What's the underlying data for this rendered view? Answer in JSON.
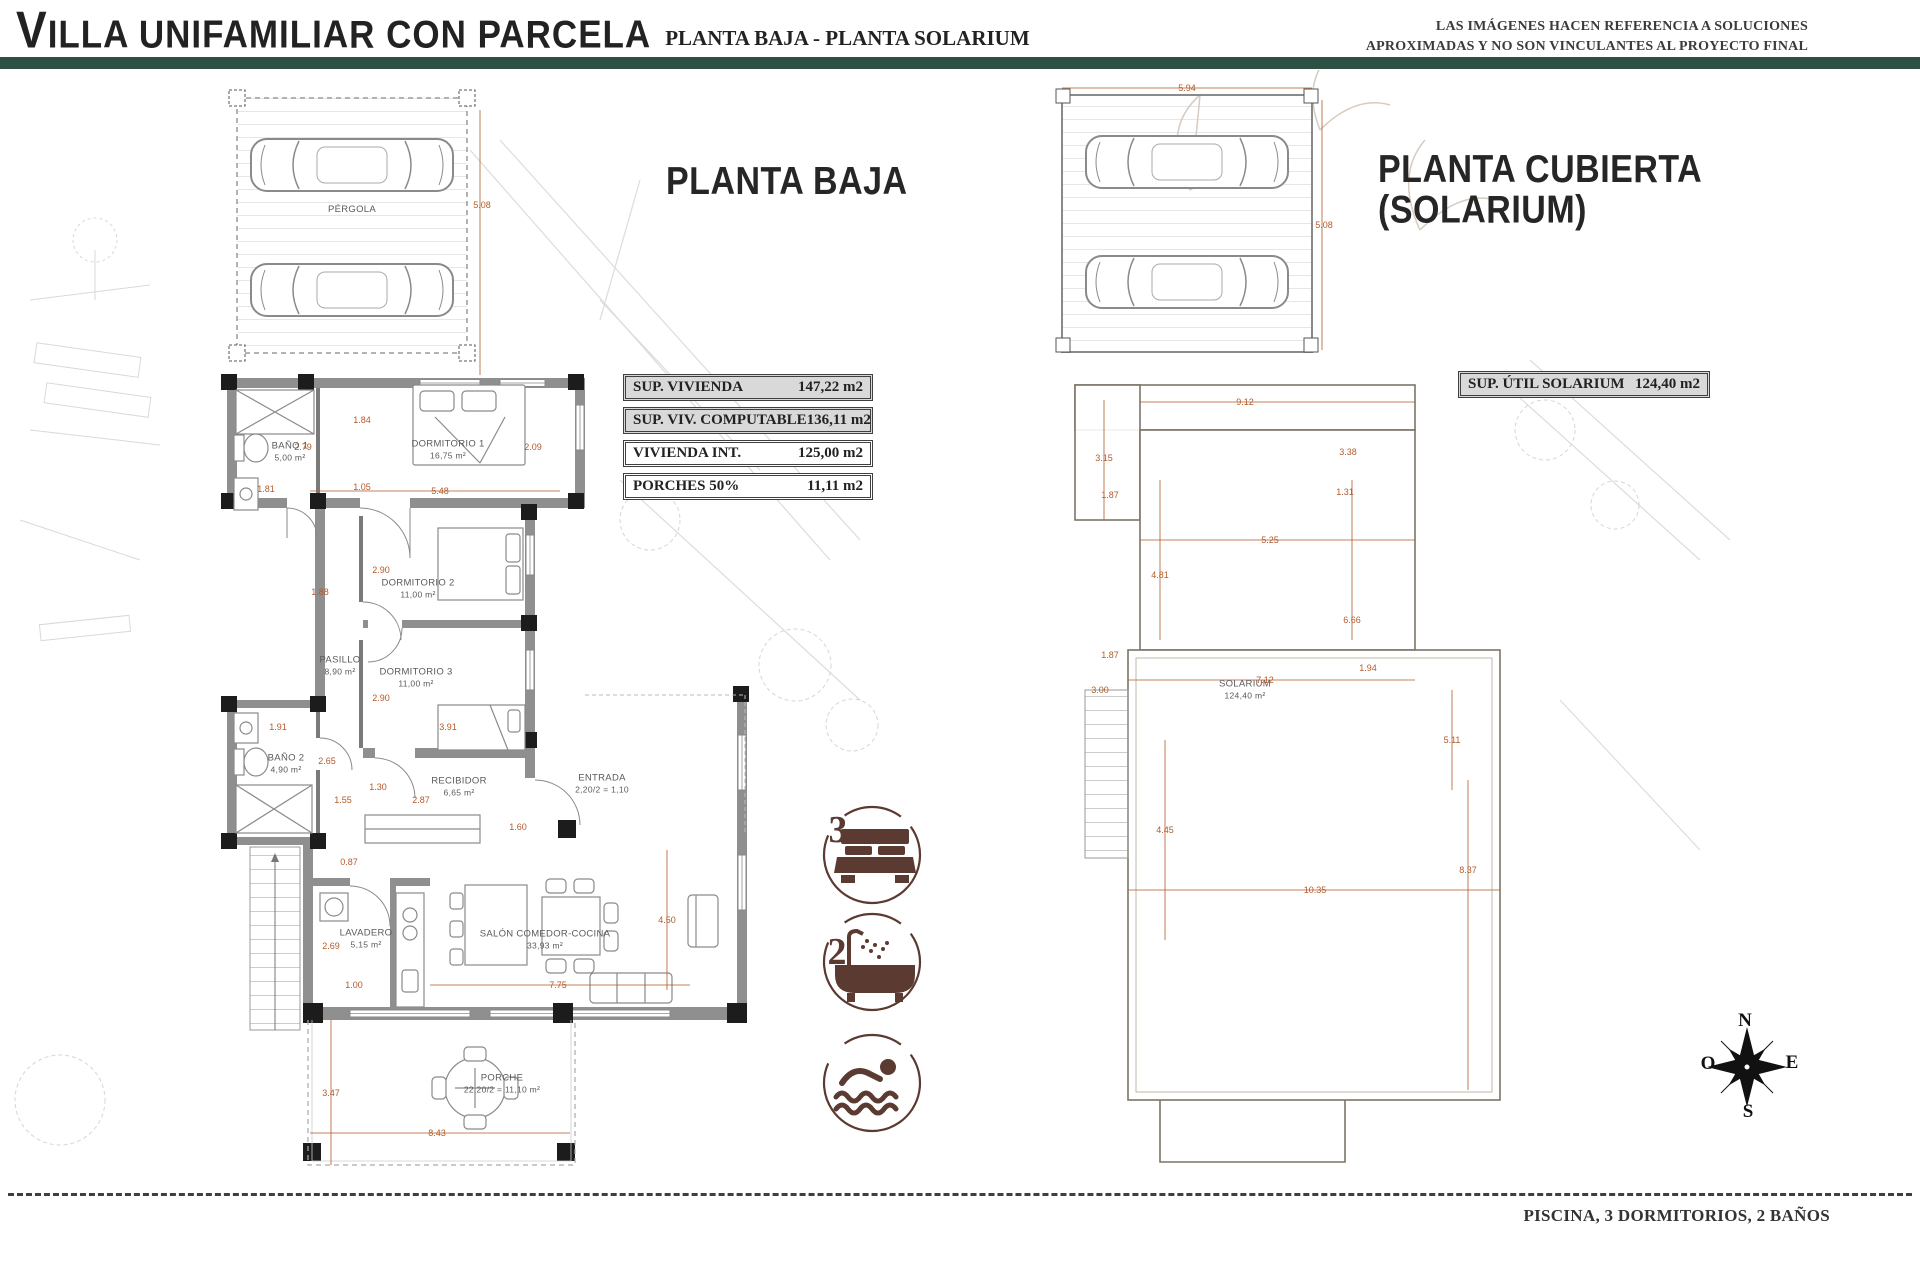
{
  "header": {
    "title_initial": "V",
    "title_rest": "ILLA UNIFAMILIAR CON PARCELA",
    "subtitle": "PLANTA BAJA - PLANTA SOLARIUM",
    "disclaimer_line1": "LAS IMÁGENES HACEN REFERENCIA A SOLUCIONES",
    "disclaimer_line2": "APROXIMADAS Y NO SON VINCULANTES AL PROYECTO FINAL",
    "accent_color": "#2c5044"
  },
  "planta_baja": {
    "title": "PLANTA BAJA",
    "areas_table": [
      {
        "label": "SUP. VIVIENDA",
        "value": "147,22 m2",
        "shaded": true
      },
      {
        "label": "SUP. VIV. COMPUTABLE",
        "value": "136,11 m2",
        "shaded": true
      },
      {
        "label": "VIVIENDA INT.",
        "value": "125,00 m2",
        "shaded": false
      },
      {
        "label": "PORCHES 50%",
        "value": "11,11 m2",
        "shaded": false
      }
    ],
    "rooms": [
      {
        "name": "PÉRGOLA",
        "area": "",
        "x": 352,
        "y": 210
      },
      {
        "name": "BAÑO 1",
        "area": "5,00 m²",
        "x": 290,
        "y": 452
      },
      {
        "name": "DORMITORIO 1",
        "area": "16,75 m²",
        "x": 448,
        "y": 450
      },
      {
        "name": "DORMITORIO 2",
        "area": "11,00 m²",
        "x": 418,
        "y": 589
      },
      {
        "name": "PASILLO",
        "area": "8,90 m²",
        "x": 340,
        "y": 666
      },
      {
        "name": "DORMITORIO 3",
        "area": "11,00 m²",
        "x": 416,
        "y": 678
      },
      {
        "name": "BAÑO 2",
        "area": "4,90 m²",
        "x": 286,
        "y": 764
      },
      {
        "name": "RECIBIDOR",
        "area": "6,65 m²",
        "x": 459,
        "y": 787
      },
      {
        "name": "ENTRADA",
        "area": "2,20/2 = 1,10",
        "x": 602,
        "y": 784
      },
      {
        "name": "LAVADERO",
        "area": "5,15 m²",
        "x": 366,
        "y": 939
      },
      {
        "name": "SALÓN COMEDOR-COCINA",
        "area": "33,93 m²",
        "x": 545,
        "y": 940
      },
      {
        "name": "PORCHE",
        "area": "22,20/2 = 11,10 m²",
        "x": 502,
        "y": 1084
      }
    ],
    "dims": [
      {
        "t": "5.08",
        "x": 482,
        "y": 205
      },
      {
        "t": "1.84",
        "x": 362,
        "y": 420
      },
      {
        "t": "2.79",
        "x": 303,
        "y": 447
      },
      {
        "t": "2.09",
        "x": 533,
        "y": 447
      },
      {
        "t": "1.81",
        "x": 266,
        "y": 489
      },
      {
        "t": "1.05",
        "x": 362,
        "y": 487
      },
      {
        "t": "5.48",
        "x": 440,
        "y": 491
      },
      {
        "t": "2.90",
        "x": 381,
        "y": 570
      },
      {
        "t": "1.88",
        "x": 320,
        "y": 592
      },
      {
        "t": "2.90",
        "x": 381,
        "y": 698
      },
      {
        "t": "1.91",
        "x": 278,
        "y": 727
      },
      {
        "t": "3.91",
        "x": 448,
        "y": 727
      },
      {
        "t": "2.65",
        "x": 327,
        "y": 761
      },
      {
        "t": "1.30",
        "x": 378,
        "y": 787
      },
      {
        "t": "1.55",
        "x": 343,
        "y": 800
      },
      {
        "t": "2.87",
        "x": 421,
        "y": 800
      },
      {
        "t": "1.60",
        "x": 518,
        "y": 827
      },
      {
        "t": "0.87",
        "x": 349,
        "y": 862
      },
      {
        "t": "2.69",
        "x": 331,
        "y": 946
      },
      {
        "t": "1.00",
        "x": 354,
        "y": 985
      },
      {
        "t": "7.75",
        "x": 558,
        "y": 985
      },
      {
        "t": "4.50",
        "x": 667,
        "y": 920
      },
      {
        "t": "3.47",
        "x": 331,
        "y": 1093
      },
      {
        "t": "8.43",
        "x": 437,
        "y": 1133
      }
    ]
  },
  "planta_cubierta": {
    "title_line1": "PLANTA CUBIERTA",
    "title_line2": "(SOLARIUM)",
    "table_label": "SUP. ÚTIL SOLARIUM",
    "table_value": "124,40 m2",
    "room": {
      "name": "SOLARIUM",
      "area": "124,40 m²",
      "x": 1245,
      "y": 690
    },
    "dims": [
      {
        "t": "5.94",
        "x": 1187,
        "y": 88
      },
      {
        "t": "5.08",
        "x": 1324,
        "y": 225
      },
      {
        "t": "9.12",
        "x": 1245,
        "y": 402
      },
      {
        "t": "3.15",
        "x": 1104,
        "y": 458
      },
      {
        "t": "3.38",
        "x": 1348,
        "y": 452
      },
      {
        "t": "1.87",
        "x": 1110,
        "y": 495
      },
      {
        "t": "1.31",
        "x": 1345,
        "y": 492
      },
      {
        "t": "5.25",
        "x": 1270,
        "y": 540
      },
      {
        "t": "4.81",
        "x": 1160,
        "y": 575
      },
      {
        "t": "6.66",
        "x": 1352,
        "y": 620
      },
      {
        "t": "1.87",
        "x": 1110,
        "y": 655
      },
      {
        "t": "1.94",
        "x": 1368,
        "y": 668
      },
      {
        "t": "7.12",
        "x": 1265,
        "y": 680
      },
      {
        "t": "3.00",
        "x": 1100,
        "y": 690
      },
      {
        "t": "5.11",
        "x": 1452,
        "y": 740
      },
      {
        "t": "4.45",
        "x": 1165,
        "y": 830
      },
      {
        "t": "8.37",
        "x": 1468,
        "y": 870
      },
      {
        "t": "10.35",
        "x": 1315,
        "y": 890
      }
    ]
  },
  "features": {
    "bedrooms": "3",
    "bathrooms": "2",
    "icon_color": "#5b3a31"
  },
  "compass": {
    "north": "N",
    "east": "E",
    "south": "S",
    "west": "O"
  },
  "footer": {
    "summary": "PISCINA, 3 DORMITORIOS, 2 BAÑOS"
  }
}
